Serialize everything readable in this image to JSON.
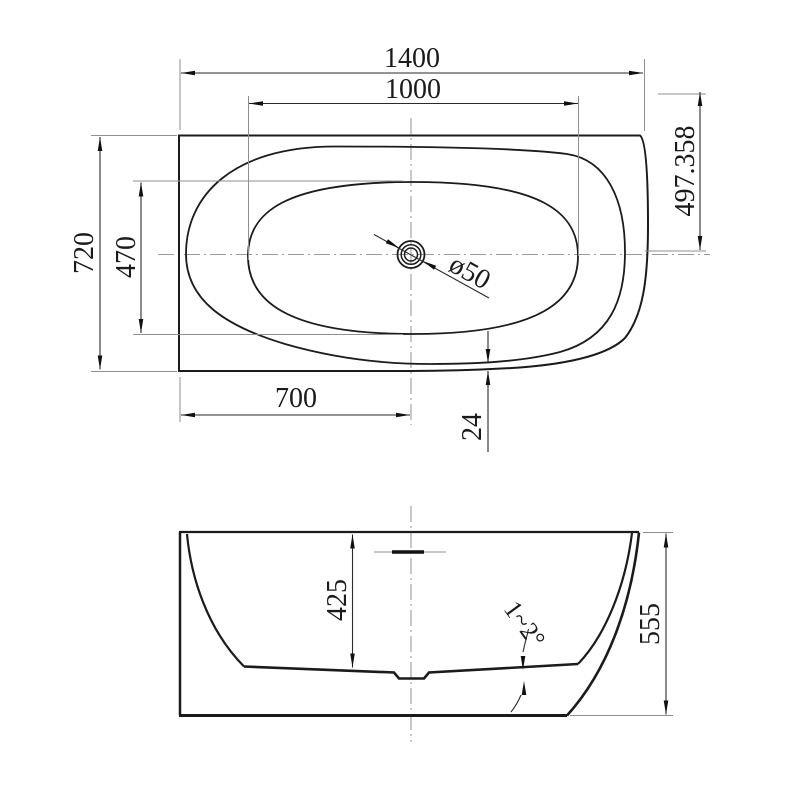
{
  "drawing": {
    "background": "#ffffff",
    "line_color": "#1b1b1b",
    "aux_line_color": "#9b9b9b",
    "top_view": {
      "name": "bathtub-plan-view",
      "dims": {
        "overall_length": "1400",
        "basin_length": "1000",
        "overall_width": "720",
        "basin_width": "470",
        "drain_from_left": "700",
        "rim_gap": "24",
        "corner_offset": "497.358",
        "drain_diameter": "ø50"
      }
    },
    "side_view": {
      "name": "bathtub-front-elevation",
      "dims": {
        "inner_depth": "425",
        "overall_height": "555",
        "floor_slope": "1~2°"
      }
    }
  }
}
